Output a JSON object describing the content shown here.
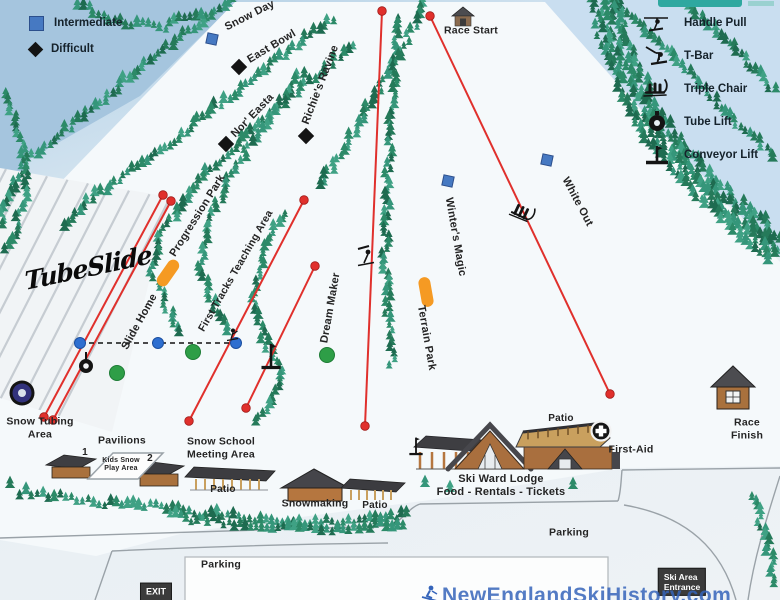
{
  "legend": {
    "difficulty": [
      {
        "label": "Intermediate",
        "symbol": "blue-square"
      },
      {
        "label": "Difficult",
        "symbol": "black-diamond"
      }
    ],
    "lifts": [
      {
        "label": "Handle Pull",
        "symbol": "handle-pull-icon"
      },
      {
        "label": "T-Bar",
        "symbol": "t-bar-icon"
      },
      {
        "label": "Triple Chair",
        "symbol": "triple-chair-icon"
      },
      {
        "label": "Tube Lift",
        "symbol": "tube-lift-icon"
      },
      {
        "label": "Conveyor Lift",
        "symbol": "conveyor-lift-icon"
      }
    ]
  },
  "trails": {
    "snow_day": "Snow Day",
    "east_bowl": "East Bowl",
    "nor_easta": "Nor' Easta",
    "richies_ravine": "Richie's Ravine",
    "progression_park": "Progression Park",
    "first_tracks": "First Tracks Teaching Area",
    "slide_home": "Slide Home",
    "dream_maker": "Dream Maker",
    "winters_magic": "Winter's Magic",
    "terrain_park": "Terrain Park",
    "white_out": "White Out"
  },
  "base_area": {
    "snow_tubing": "Snow Tubing\nArea",
    "pavilions": "Pavilions",
    "pavilion_1": "1",
    "pavilion_2": "2",
    "kids_play": "Kids Snow\nPlay Area",
    "snow_school": "Snow School\nMeeting Area",
    "patio_a": "Patio",
    "patio_b": "Patio",
    "patio_lodge": "Patio",
    "snowmaking": "Snowmaking",
    "lodge": "Ski Ward Lodge\nFood - Rentals - Tickets",
    "first_aid": "First-Aid",
    "parking_left": "Parking",
    "parking_right": "Parking",
    "race_start": "Race Start",
    "race_finish": "Race\nFinish",
    "exit_sign": "EXIT",
    "entrance_sign": "Ski Area\nEntrance"
  },
  "branding": {
    "tube_slide_logo": "TubeSlide",
    "watermark": "NewEnglandSkiHistory.com"
  },
  "colors": {
    "intermediate": "#4679c2",
    "difficult": "#141414",
    "beginner_marker": "#2e9e47",
    "lift_line": "#e0302c",
    "park_marker": "#f59a23",
    "watermark_blue": "#3564ba",
    "sign_bg": "#3b3b3b",
    "header_teal": "#2fa8a0"
  }
}
